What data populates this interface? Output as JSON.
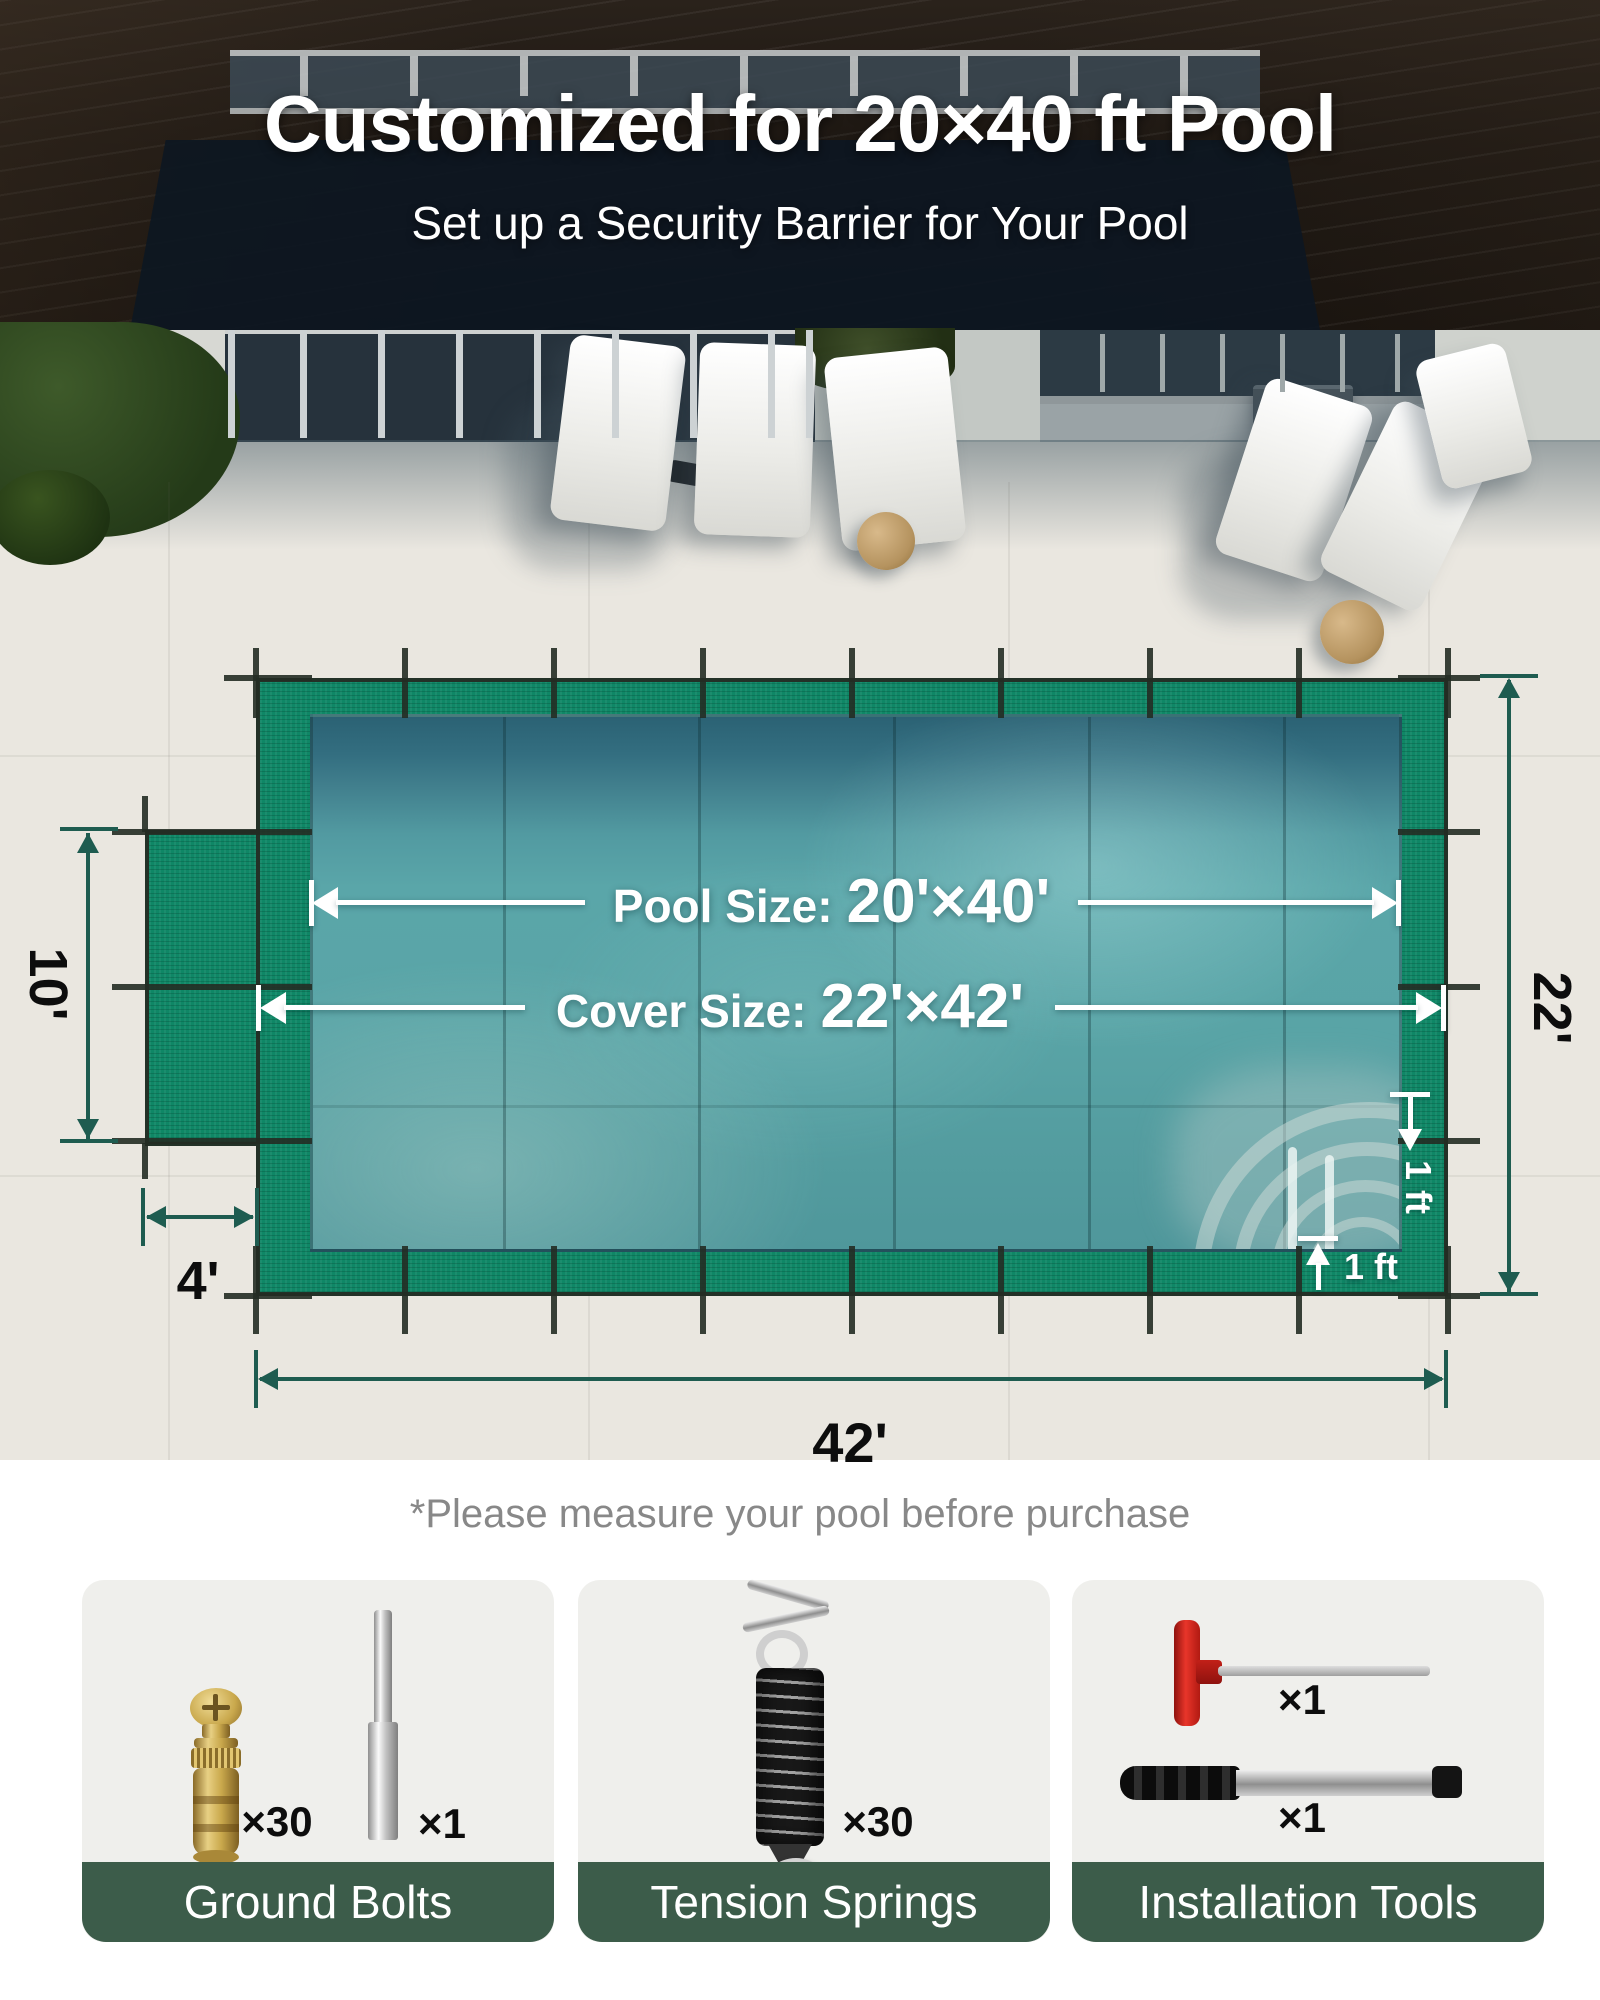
{
  "header": {
    "title": "Customized for 20×40 ft Pool",
    "subtitle": "Set up a Security Barrier for Your Pool"
  },
  "diagram": {
    "pool_size_label": "Pool Size:",
    "pool_size_value": "20'×40'",
    "cover_size_label": "Cover Size:",
    "cover_size_value": "22'×42'",
    "total_width": "42'",
    "total_height": "22'",
    "step_depth": "10'",
    "step_width": "4'",
    "overlap_right": "1 ft",
    "overlap_bottom": "1 ft"
  },
  "note": "*Please measure your pool before purchase",
  "cards": [
    {
      "label": "Ground Bolts",
      "items": [
        {
          "name": "brass ground bolt",
          "qty": "×30"
        },
        {
          "name": "installation pin",
          "qty": "×1"
        }
      ]
    },
    {
      "label": "Tension Springs",
      "items": [
        {
          "name": "tension spring",
          "qty": "×30"
        }
      ]
    },
    {
      "label": "Installation Tools",
      "items": [
        {
          "name": "hex key",
          "qty": "×1"
        },
        {
          "name": "installation rod",
          "qty": "×1"
        }
      ]
    }
  ],
  "colors": {
    "cover_green": "#0F8766",
    "dimension_arrow_green": "#1E5C50",
    "banner_green": "#3C5C4A",
    "water_teal": "#4F98A2",
    "note_gray": "#888888",
    "label_black": "#0D0D0D",
    "white": "#FFFFFF"
  }
}
